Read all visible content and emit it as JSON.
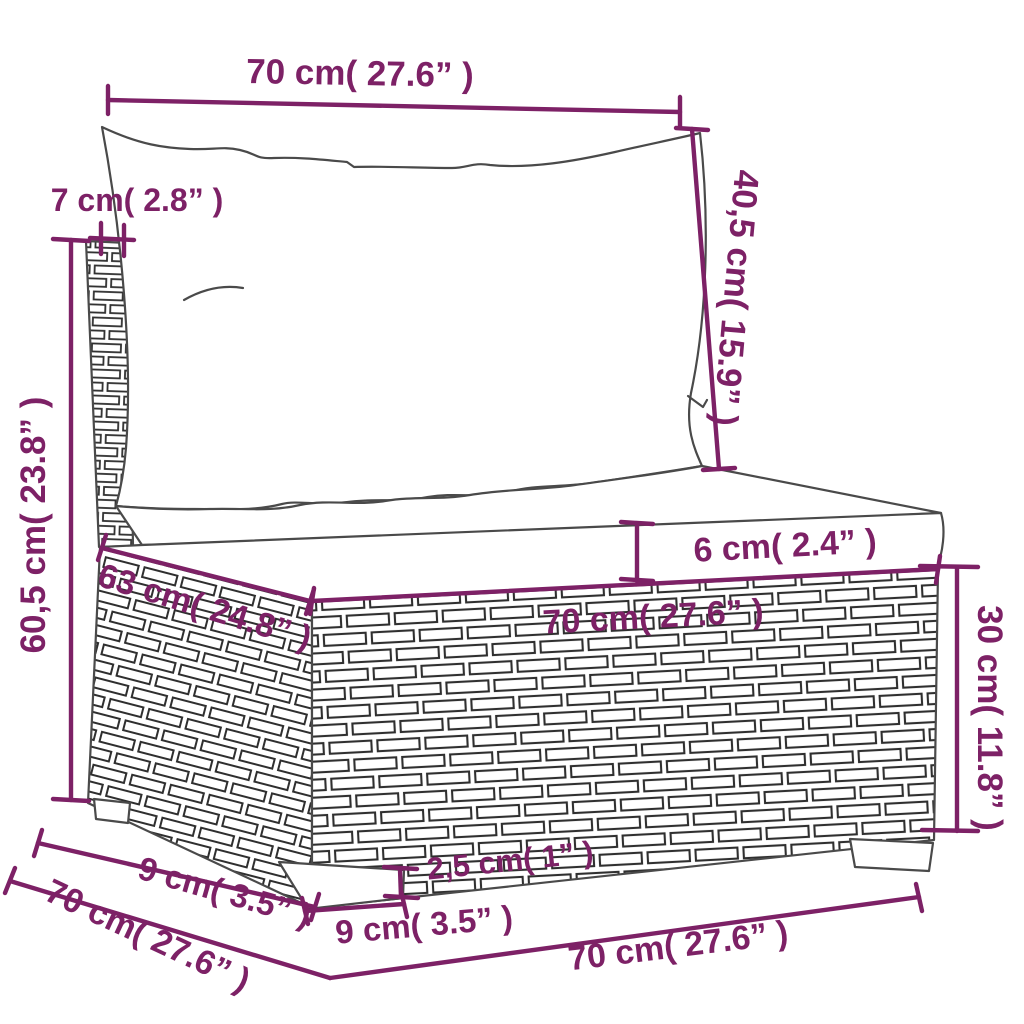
{
  "figure": {
    "subject": "wicker-garden-sofa-dimension-diagram"
  },
  "colors": {
    "annotation": "#7D2166",
    "line_art": "#4A4A4A",
    "background": "#FFFFFF"
  },
  "dims": {
    "top_width": "70 cm( 27.6” )",
    "back_panel_thickness": "7 cm( 2.8” )",
    "overall_height": "60,5 cm( 23.8” )",
    "back_cushion_height": "40,5 cm( 15.9” )",
    "seat_cushion_thickness": "6 cm( 2.4” )",
    "seat_depth": "63 cm( 24.8” )",
    "seat_width": "70 cm( 27.6” )",
    "base_height": "30 cm( 11.8” )",
    "overall_depth": "70 cm( 27.6” )",
    "leg_inset_depth": "9 cm( 3.5” )",
    "leg_width": "9 cm( 3.5” )",
    "leg_height": "2,5 cm( 1” )",
    "overall_width": "70 cm( 27.6” )"
  }
}
